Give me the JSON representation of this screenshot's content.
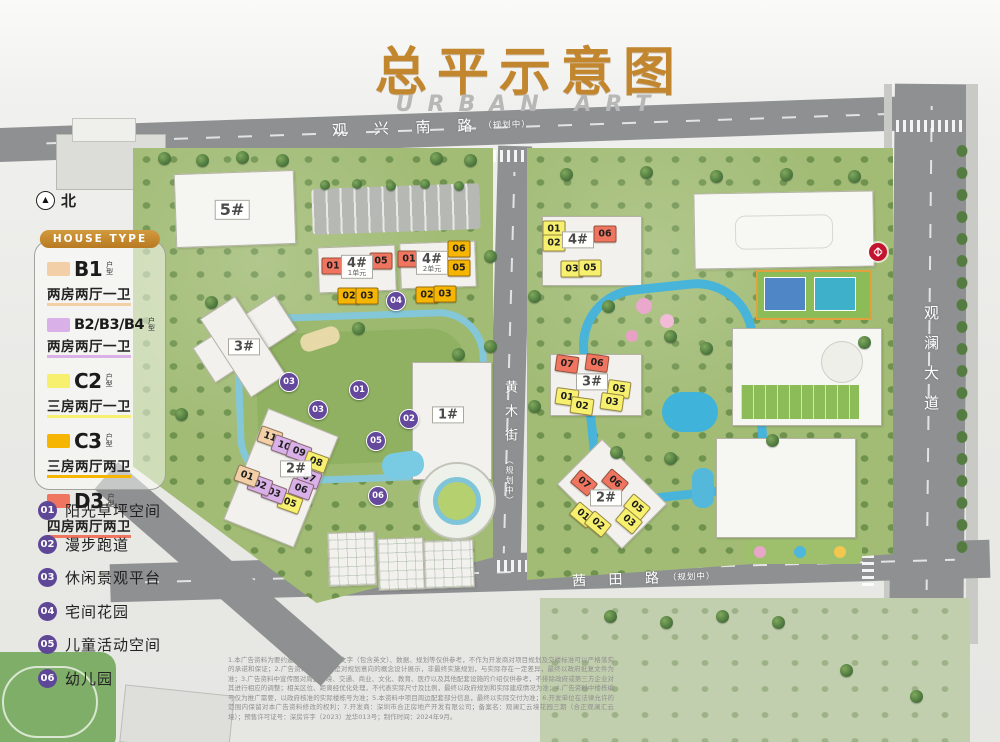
{
  "title": {
    "main": "总平示意图",
    "sub": "URBAN ART"
  },
  "north_label": "北",
  "icons": {
    "north_arrow": "▲",
    "metro_station": "shenzhen-metro-logo"
  },
  "legend": {
    "header": "HOUSE TYPE",
    "items": [
      {
        "code": "B1",
        "tag": "户型",
        "desc": "两房两厅一卫",
        "color": "#f2cfa6"
      },
      {
        "code": "B2/B3/B4",
        "tag": "户型",
        "desc": "两房两厅一卫",
        "color": "#d9b0e8"
      },
      {
        "code": "C2",
        "tag": "户型",
        "desc": "三房两厅一卫",
        "color": "#f7f06e"
      },
      {
        "code": "C3",
        "tag": "户型",
        "desc": "三房两厅两卫",
        "color": "#f6b501"
      },
      {
        "code": "D3",
        "tag": "户型",
        "desc": "四房两厅两卫",
        "color": "#ef7561"
      }
    ]
  },
  "house_colors": {
    "B1": "#f2cfa6",
    "B234": "#d9b0e8",
    "C2": "#f7f06e",
    "C3": "#f6b501",
    "D3": "#ef7561"
  },
  "amenities": [
    {
      "num": "01",
      "label": "阳光草坪空间"
    },
    {
      "num": "02",
      "label": "漫步跑道"
    },
    {
      "num": "03",
      "label": "休闲景观平台"
    },
    {
      "num": "04",
      "label": "宅间花园"
    },
    {
      "num": "05",
      "label": "儿童活动空间"
    },
    {
      "num": "06",
      "label": "幼儿园"
    }
  ],
  "roads": {
    "north": {
      "name": "观 兴 南 路",
      "note": "（规划中）"
    },
    "east": {
      "name": "观澜大道",
      "note": ""
    },
    "middle": {
      "name": "黄木街",
      "note": "（规划中）"
    },
    "south": {
      "name": "茜 田 路",
      "note": "（规划中）"
    }
  },
  "map": {
    "building_labels": [
      {
        "main": "5#",
        "x": 232,
        "y": 210,
        "fs": 16
      },
      {
        "main": "4#",
        "sub": "1单元",
        "x": 357,
        "y": 267
      },
      {
        "main": "4#",
        "sub": "2单元",
        "x": 432,
        "y": 263
      },
      {
        "main": "3#",
        "x": 244,
        "y": 347
      },
      {
        "main": "1#",
        "x": 448,
        "y": 415
      },
      {
        "main": "2#",
        "x": 296,
        "y": 469
      },
      {
        "main": "4#",
        "x": 578,
        "y": 240
      },
      {
        "main": "3#",
        "x": 592,
        "y": 382
      },
      {
        "main": "2#",
        "x": 606,
        "y": 498
      }
    ],
    "unit_chips": [
      {
        "t": "D3",
        "n": "01",
        "x": 333,
        "y": 266
      },
      {
        "t": "D3",
        "n": "05",
        "x": 381,
        "y": 261
      },
      {
        "t": "D3",
        "n": "01",
        "x": 409,
        "y": 259
      },
      {
        "t": "C3",
        "n": "06",
        "x": 459,
        "y": 249
      },
      {
        "t": "C3",
        "n": "05",
        "x": 459,
        "y": 268
      },
      {
        "t": "C3",
        "n": "02",
        "x": 349,
        "y": 296
      },
      {
        "t": "C3",
        "n": "03",
        "x": 367,
        "y": 296
      },
      {
        "t": "C3",
        "n": "02",
        "x": 427,
        "y": 295
      },
      {
        "t": "C3",
        "n": "03",
        "x": 445,
        "y": 294
      },
      {
        "t": "B1",
        "n": "11",
        "x": 270,
        "y": 437,
        "r": 20
      },
      {
        "t": "B234",
        "n": "10",
        "x": 284,
        "y": 446,
        "r": 20
      },
      {
        "t": "B234",
        "n": "09",
        "x": 299,
        "y": 452,
        "r": 20
      },
      {
        "t": "C2",
        "n": "08",
        "x": 316,
        "y": 462,
        "r": 20
      },
      {
        "t": "B234",
        "n": "07",
        "x": 309,
        "y": 478,
        "r": 20
      },
      {
        "t": "B234",
        "n": "06",
        "x": 301,
        "y": 489,
        "r": 20
      },
      {
        "t": "C2",
        "n": "05",
        "x": 290,
        "y": 503,
        "r": 20
      },
      {
        "t": "B234",
        "n": "03",
        "x": 274,
        "y": 493,
        "r": 20
      },
      {
        "t": "B234",
        "n": "02",
        "x": 260,
        "y": 485,
        "r": 20
      },
      {
        "t": "B1",
        "n": "01",
        "x": 247,
        "y": 476,
        "r": 20
      },
      {
        "t": "C2",
        "n": "01",
        "x": 554,
        "y": 229
      },
      {
        "t": "C2",
        "n": "02",
        "x": 554,
        "y": 243
      },
      {
        "t": "D3",
        "n": "06",
        "x": 605,
        "y": 234
      },
      {
        "t": "C2",
        "n": "03",
        "x": 572,
        "y": 269
      },
      {
        "t": "C2",
        "n": "05",
        "x": 590,
        "y": 268
      },
      {
        "t": "D3",
        "n": "07",
        "x": 567,
        "y": 364,
        "r": 8
      },
      {
        "t": "D3",
        "n": "06",
        "x": 597,
        "y": 363,
        "r": 8
      },
      {
        "t": "C2",
        "n": "05",
        "x": 619,
        "y": 389,
        "r": 8
      },
      {
        "t": "C2",
        "n": "01",
        "x": 567,
        "y": 397,
        "r": 8
      },
      {
        "t": "C2",
        "n": "02",
        "x": 582,
        "y": 406,
        "r": 8
      },
      {
        "t": "C2",
        "n": "03",
        "x": 612,
        "y": 402,
        "r": 8
      },
      {
        "t": "D3",
        "n": "07",
        "x": 584,
        "y": 483,
        "r": 40
      },
      {
        "t": "D3",
        "n": "06",
        "x": 615,
        "y": 482,
        "r": 40
      },
      {
        "t": "C2",
        "n": "01",
        "x": 583,
        "y": 515,
        "r": 40
      },
      {
        "t": "C2",
        "n": "02",
        "x": 598,
        "y": 524,
        "r": 40
      },
      {
        "t": "C2",
        "n": "05",
        "x": 637,
        "y": 507,
        "r": 40
      },
      {
        "t": "C2",
        "n": "03",
        "x": 629,
        "y": 521,
        "r": 40
      }
    ],
    "markers": [
      {
        "n": "04",
        "x": 396,
        "y": 301
      },
      {
        "n": "03",
        "x": 289,
        "y": 382
      },
      {
        "n": "01",
        "x": 359,
        "y": 390
      },
      {
        "n": "03",
        "x": 318,
        "y": 410
      },
      {
        "n": "02",
        "x": 409,
        "y": 419
      },
      {
        "n": "05",
        "x": 376,
        "y": 441
      },
      {
        "n": "06",
        "x": 378,
        "y": 496
      }
    ]
  },
  "disclaimer": "1.本广告资料为要约邀请，所有图片、文字（包含英文）、数据、规划等仅供参考，不作为开发商对项目规划及交楼标准可以严格落实的承诺和保证；2.广告资料中宣传图是对规划意向的概念设计展示，非最终实施规划，与实际存在一定差异，最终以政府批复文件为准；3.广告资料中宣传图对周边环境、交通、商业、文化、教育、医疗以及其他配套设施的介绍仅供参考，不排除政府或第三方企业对其进行相应的调整；相关区位、距离经优化处理，不代表实际尺寸及比例，最终以政府规划和实际建成情况为准；4.广告资料中楼栋编号仅为推广需要，以政府核准的实际楼栋号为准；5.本资料中项目周边配套部分信息，最终以实际交付为准；6.开发单位在法律允许的范围内保留对本广告资料修改的权利；7.开发商：深圳市合正房地产开发有限公司；备案名：观澜汇云境花园三期（合正观澜汇云境）；预售许可证号：深房许字（2023）龙华013号；制作时间：2024年9月。"
}
